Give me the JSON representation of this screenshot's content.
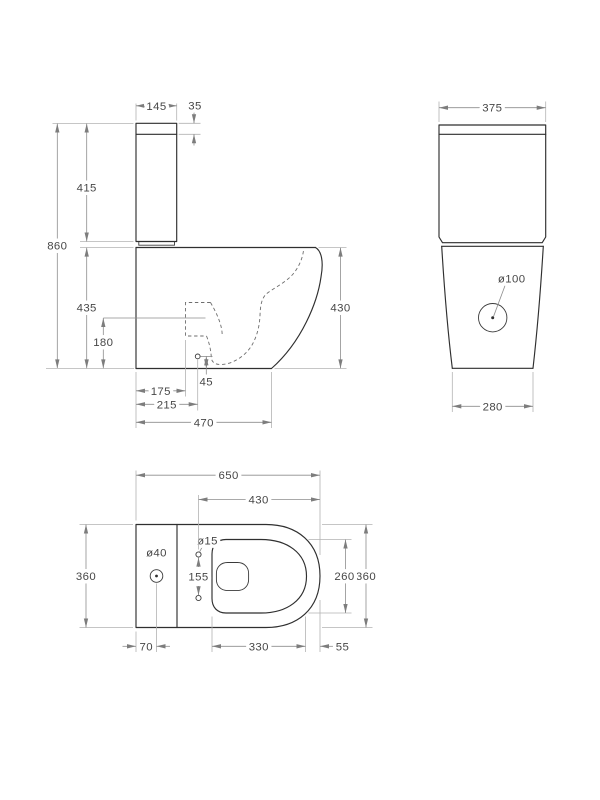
{
  "views": {
    "side": {
      "tank_width": "145",
      "lid_height": "35",
      "tank_height": "415",
      "overall_height": "860",
      "bowl_height": "435",
      "trap_height": "180",
      "bowl_front_height": "430",
      "trap_offset": "175",
      "outlet_offset": "215",
      "overall_depth": "470",
      "outlet_drop": "45"
    },
    "front": {
      "tank_width": "375",
      "outlet_diameter": "ø100",
      "base_width": "280"
    },
    "plan": {
      "overall_length": "650",
      "rim_length": "430",
      "overall_width_left": "360",
      "overall_width_right": "360",
      "rim_width": "260",
      "tank_hole_diameter": "ø40",
      "seat_hole_diameter": "ø15",
      "seat_hole_spacing": "155",
      "tank_hole_offset": "70",
      "rim_span": "330",
      "front_overhang": "55"
    }
  }
}
